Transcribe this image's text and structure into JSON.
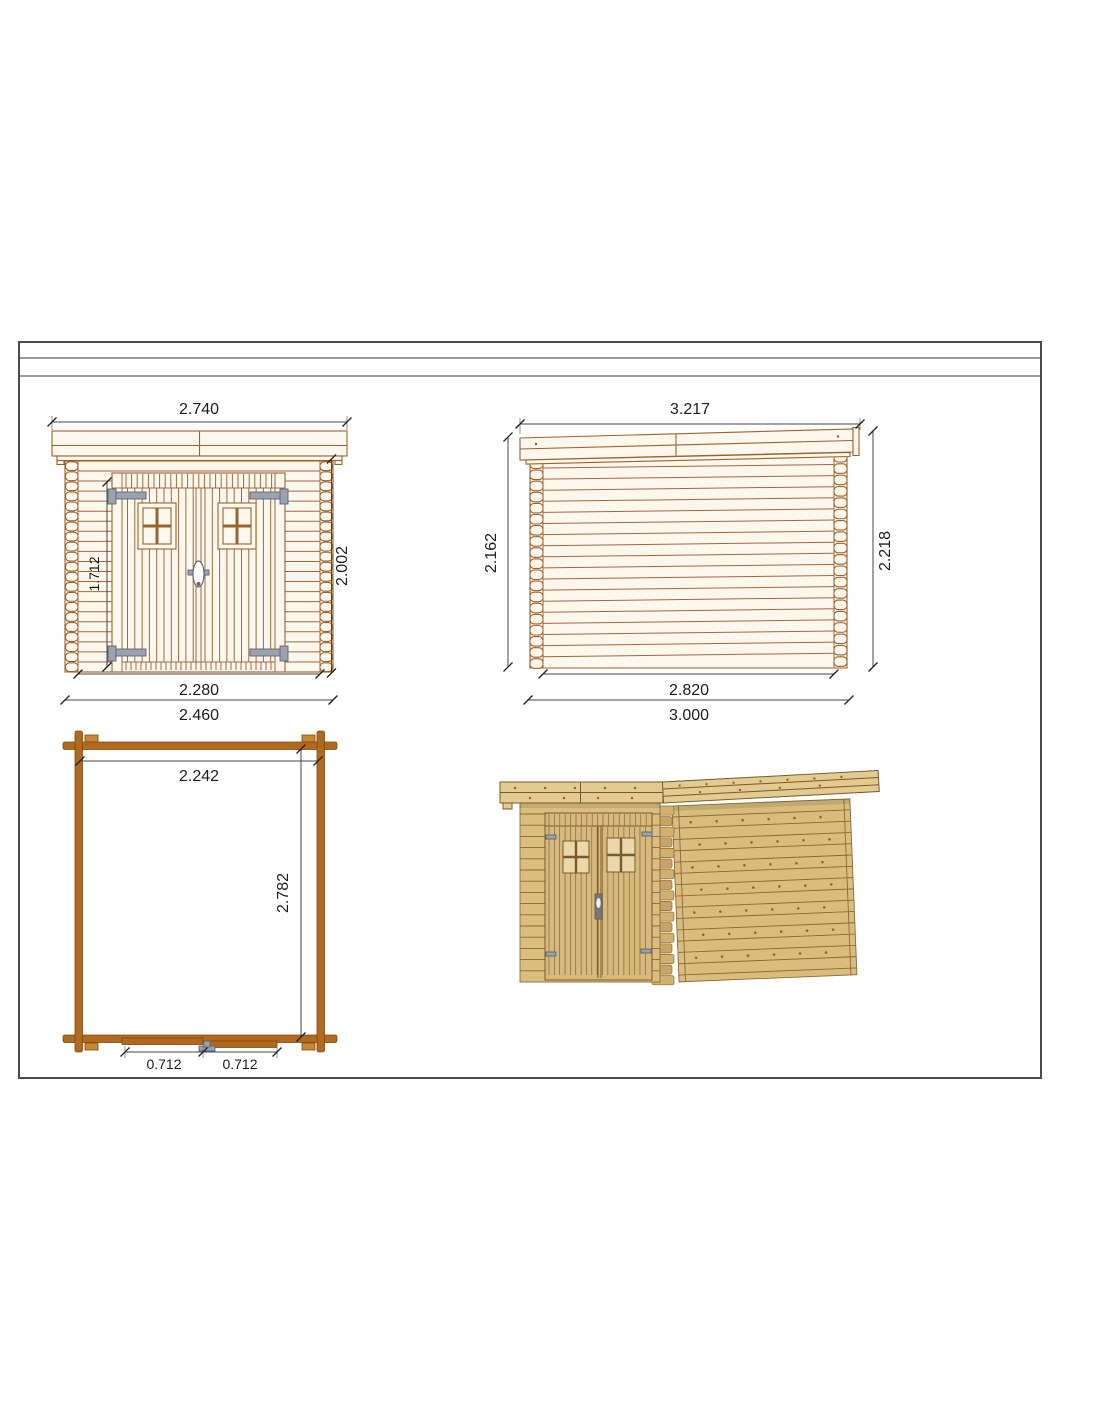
{
  "sheet": {
    "type": "technical-drawing",
    "views": [
      "front-elevation",
      "side-elevation",
      "floor-plan",
      "3d-render"
    ]
  },
  "dims": {
    "front": {
      "roof_width": "2.740",
      "door_height": "1.712",
      "wall_height": "2.002",
      "inner_width": "2.280",
      "outer_width": "2.460"
    },
    "side": {
      "roof_length": "3.217",
      "left_height": "2.162",
      "right_height": "2.218",
      "inner_length": "2.820",
      "outer_length": "3.000"
    },
    "plan": {
      "inner_width": "2.242",
      "inner_depth": "2.782",
      "left_door": "0.712",
      "right_door": "0.712"
    }
  },
  "colors": {
    "outline_brown": "#9c6229",
    "wood_fill": "#fdf8ee",
    "plan_wall": "#b0691d",
    "hardware_gray": "#9aa2b0",
    "render_wood": "#d9bc7e",
    "render_roof": "#e3ca90",
    "render_line": "#8a6a33",
    "dim_line": "#444444",
    "frame_border": "#4a4a4a",
    "frame_rule": "#9a9a9a"
  }
}
